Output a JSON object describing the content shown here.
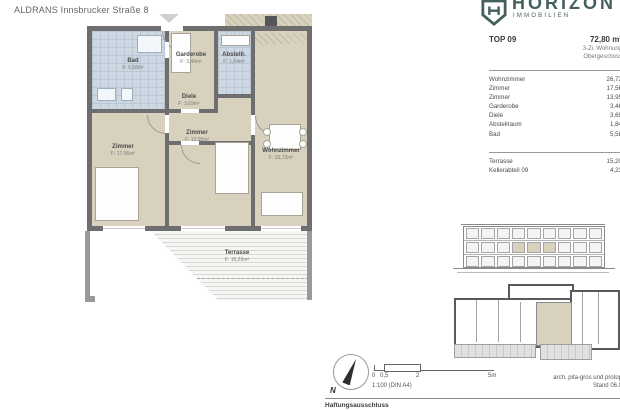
{
  "page": {
    "title": "ALDRANS Innsbrucker Straße 8"
  },
  "brand": {
    "name": "HORIZON",
    "subtitle": "IMMOBILIEN",
    "color": "#44605c"
  },
  "unit": {
    "id": "TOP 09",
    "total_area": "72,80 m²",
    "type": "3-Zi. Wohnung",
    "level": "Obergeschoss"
  },
  "area_table": {
    "rows": [
      {
        "label": "Wohnzimmer",
        "value": "26,72"
      },
      {
        "label": "Zimmer",
        "value": "17,56"
      },
      {
        "label": "Zimmer",
        "value": "13,95"
      },
      {
        "label": "Garderobe",
        "value": "3,46"
      },
      {
        "label": "Diele",
        "value": "3,69"
      },
      {
        "label": "Abstellraum",
        "value": "1,84"
      },
      {
        "label": "Bad",
        "value": "5,58"
      }
    ],
    "extra_rows": [
      {
        "label": "Terrasse",
        "value": "15,20"
      },
      {
        "label": "Kellerabteil 09",
        "value": "4,23"
      }
    ]
  },
  "plan": {
    "rooms": [
      {
        "name": "Bad",
        "area": "F: 5,58m²"
      },
      {
        "name": "Garderobe",
        "area": "F: 3,46m²"
      },
      {
        "name": "Abstellr.",
        "area": "F: 1,84m²"
      },
      {
        "name": "Diele",
        "area": "F: 3,69m²"
      },
      {
        "name": "Zimmer",
        "area": "F: 17,56m²"
      },
      {
        "name": "Zimmer",
        "area": "F: 13,95m²"
      },
      {
        "name": "Wohnzimmer",
        "area": "F: 26,72m²"
      },
      {
        "name": "Terrasse",
        "area": "F: 15,20m²"
      }
    ]
  },
  "footer": {
    "north_label": "N",
    "scale_ticks": [
      "0",
      "0,5",
      "2",
      "5m"
    ],
    "scale_note": "1:100 (DIN A4)",
    "credit": "arch. pita-gros und protop",
    "revision": "Stand 06.0",
    "disclaimer": "Haftungsausschluss"
  }
}
